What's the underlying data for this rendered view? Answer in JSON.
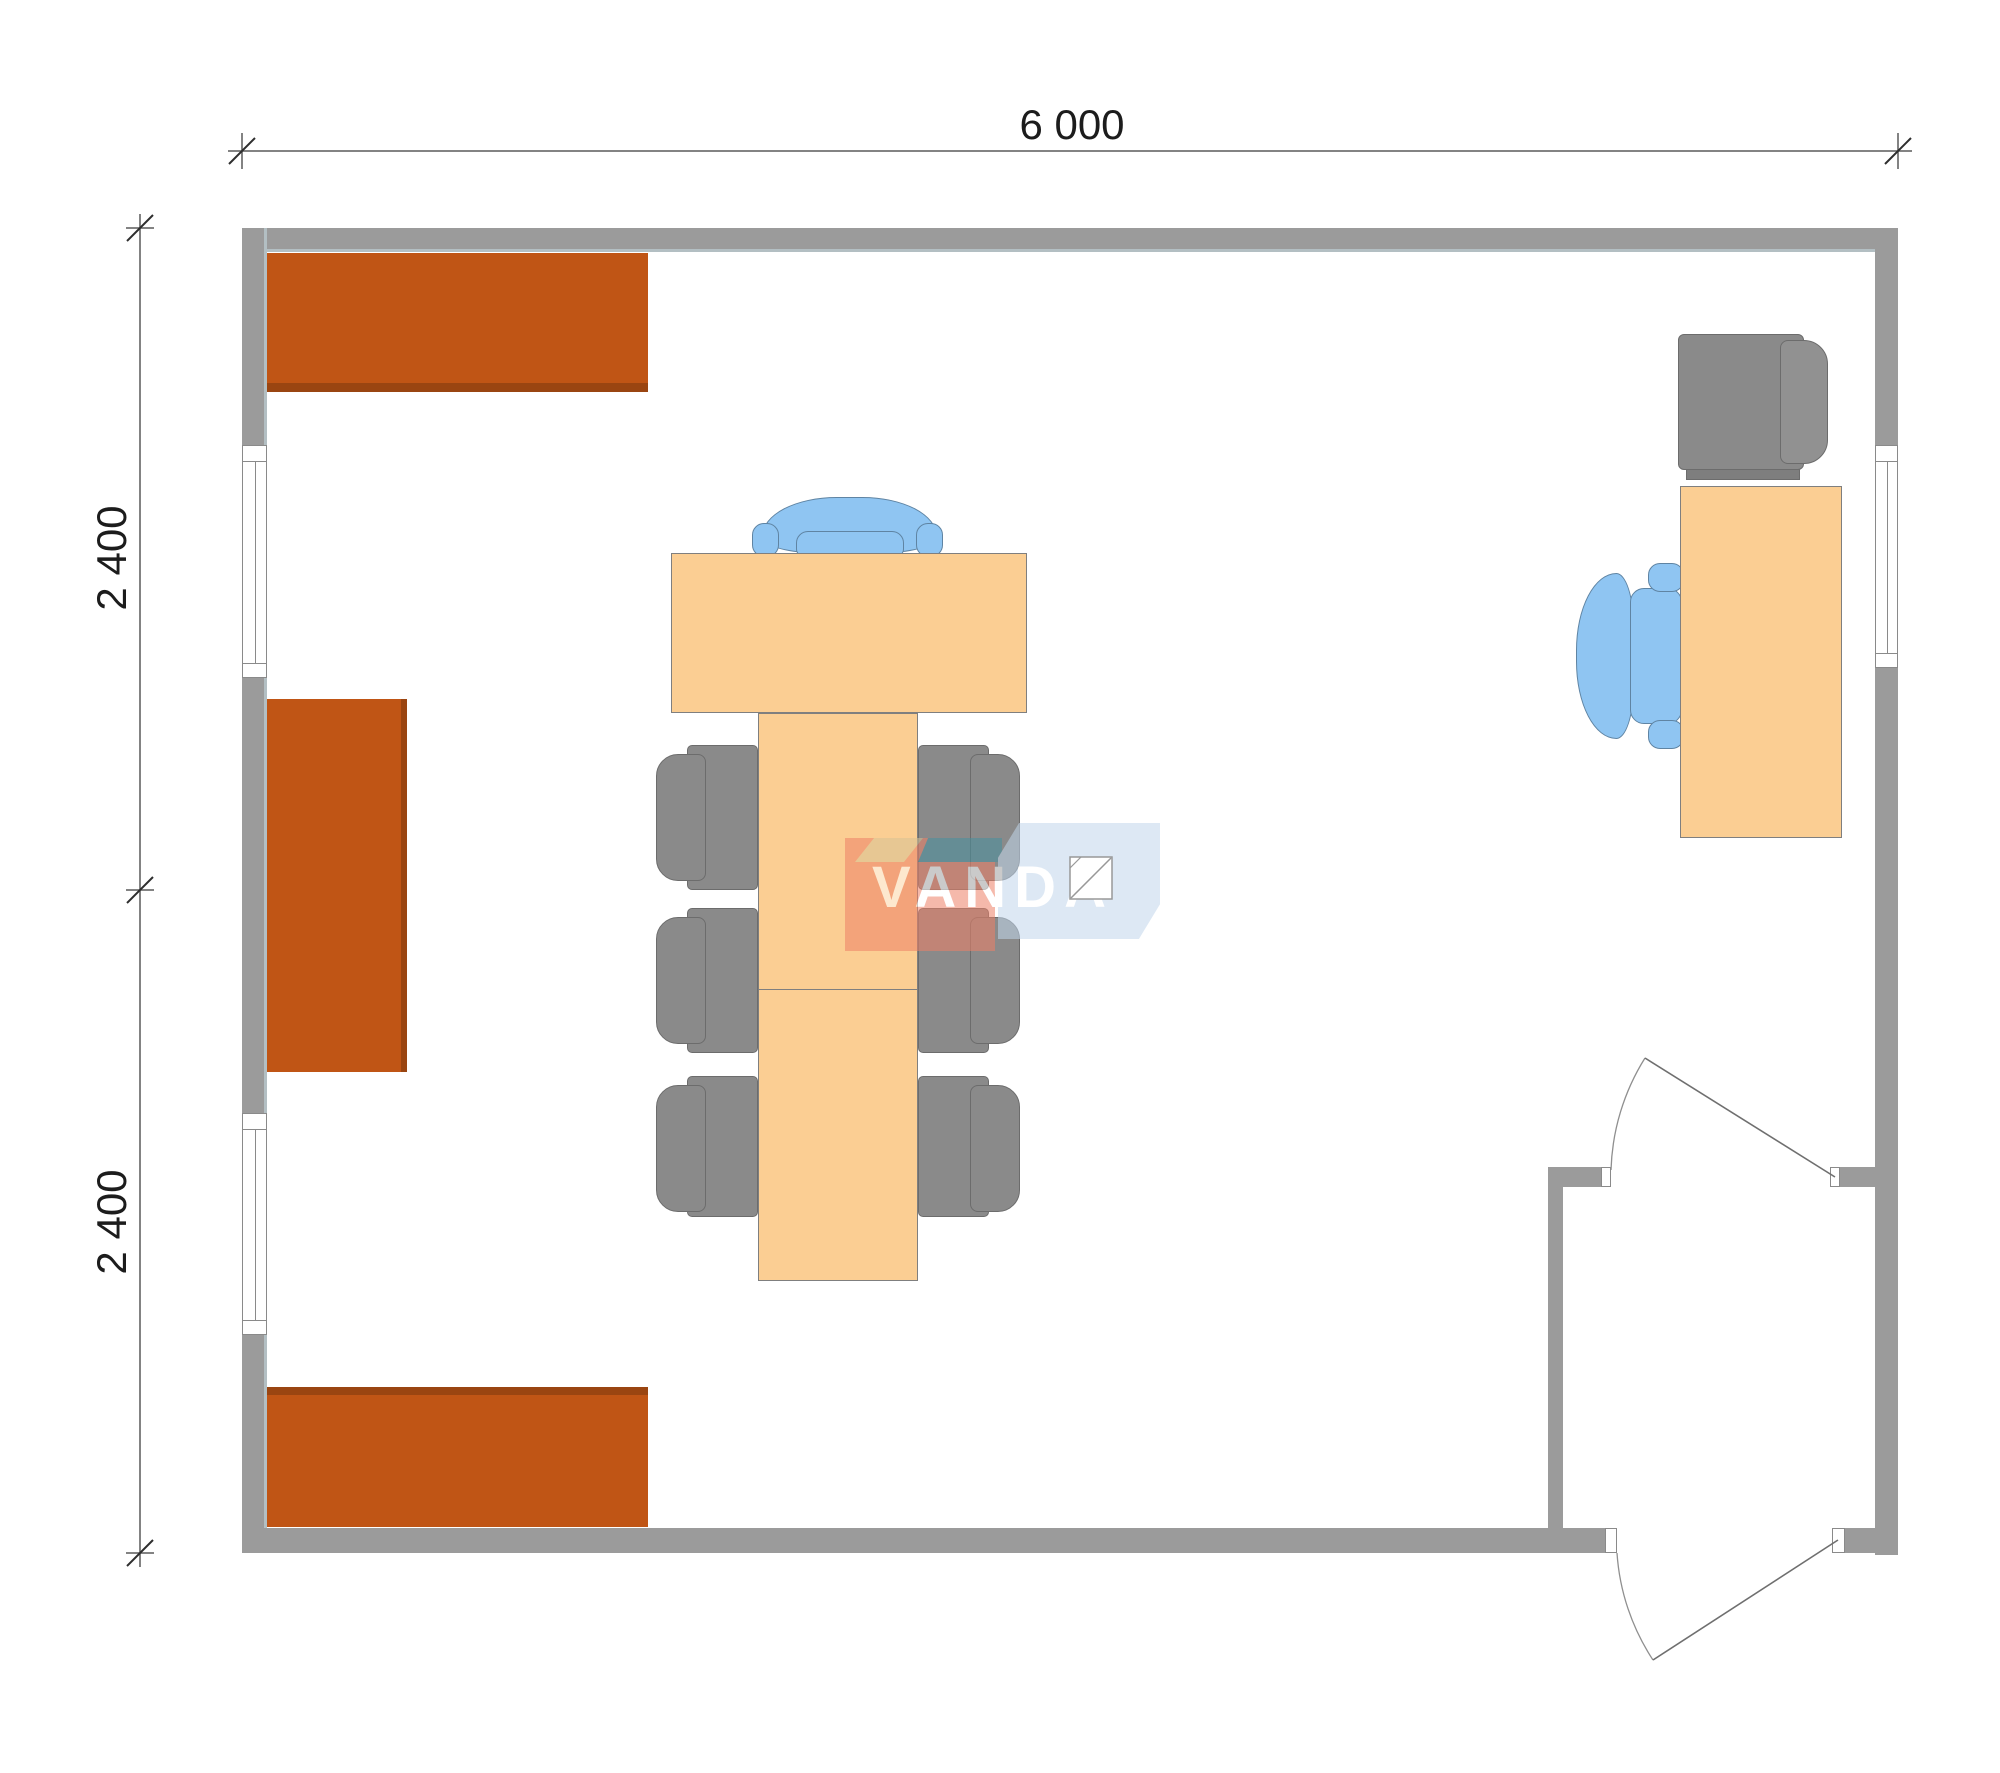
{
  "drawing": {
    "type": "architectural floor plan, top view, office module",
    "dimensions": {
      "top": {
        "label": "6 000"
      },
      "left": [
        {
          "label": "2 400"
        },
        {
          "label": "2 400"
        }
      ]
    },
    "watermark": {
      "brand": "VANDA"
    },
    "objects": [
      {
        "name": "wall-cabinet",
        "count": 3
      },
      {
        "name": "conference-table",
        "count": 1
      },
      {
        "name": "executive-chair-blue",
        "count": 1
      },
      {
        "name": "side-chair-gray",
        "count": 6
      },
      {
        "name": "office-desk",
        "count": 1
      },
      {
        "name": "desk-chair-gray",
        "count": 1
      },
      {
        "name": "task-chair-blue",
        "count": 1
      },
      {
        "name": "window",
        "count": 3
      },
      {
        "name": "swing-door",
        "count": 2
      }
    ],
    "colors": {
      "wall": "#9b9b9b",
      "cabinet": "#c05515",
      "cabinet_shadow": "#9a4511",
      "table": "#fbce93",
      "chair_gray": "#8a8a8a",
      "chair_blue": "#8fc5f2",
      "dimension_line": "#5a5a5a",
      "text": "#1c1c1c",
      "watermark_red": "#ee8067",
      "watermark_teal": "#47919e",
      "watermark_tan": "#d8c294",
      "watermark_blue": "#c2d7ec"
    }
  }
}
